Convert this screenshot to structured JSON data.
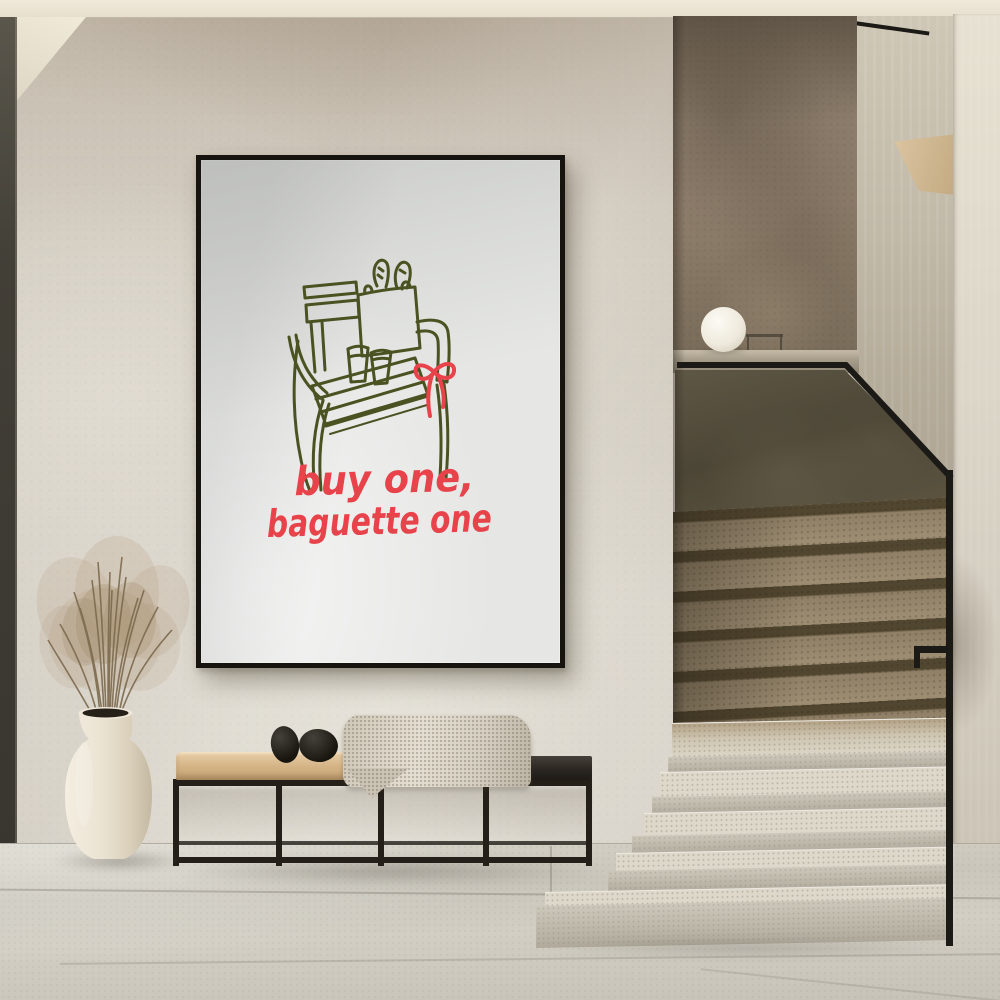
{
  "scene": {
    "description": "Minimalist entry hall: framed art print on plaster wall, metal bench with blanket and stones, ceramic vase with dried grass, terrazzo staircase with black handrail and sphere lamp",
    "poster": {
      "line1": "buy one,",
      "line2": "baguette one",
      "text_color": "#e8434b",
      "drawing_color": "#4a5222",
      "paper_color": "#e6e7e5",
      "frame_color": "#17140f",
      "drawing_objects": [
        "garden-chair",
        "tote-bag",
        "baguettes",
        "coffee-cup",
        "coffee-cup",
        "ribbon-bow"
      ]
    },
    "palette": {
      "ceiling": "#ece5d6",
      "wall": "#d3cdc2",
      "wall_top_shade": "#a3968a",
      "door_strip": "#423f37",
      "stair_upper_wall": "#887a6a",
      "stair_guard_wall": "#574f3e",
      "ledge": "#a89e8c",
      "brown_step_tread": "#9d8d73",
      "brown_step_riser": "#51462f",
      "light_step_tread": "#ddd8ca",
      "light_step_face": "#c6c1b2",
      "floor": "#cdc9bf",
      "handrail": "#1b1a17",
      "lamp": "#f4f1e9",
      "vase": "#ece5d7",
      "dried_grass": "#b49d7d",
      "bench_cushion": "#d9bd95",
      "bench_wood": "#2a2520",
      "bench_frame": "#242019",
      "blanket": "#d8d2c4",
      "pebbles": "#211f1c"
    },
    "objects": [
      "framed-poster",
      "bench",
      "blanket",
      "pebbles",
      "vase-with-dried-grass",
      "sphere-lamp",
      "staircase",
      "handrail"
    ]
  }
}
